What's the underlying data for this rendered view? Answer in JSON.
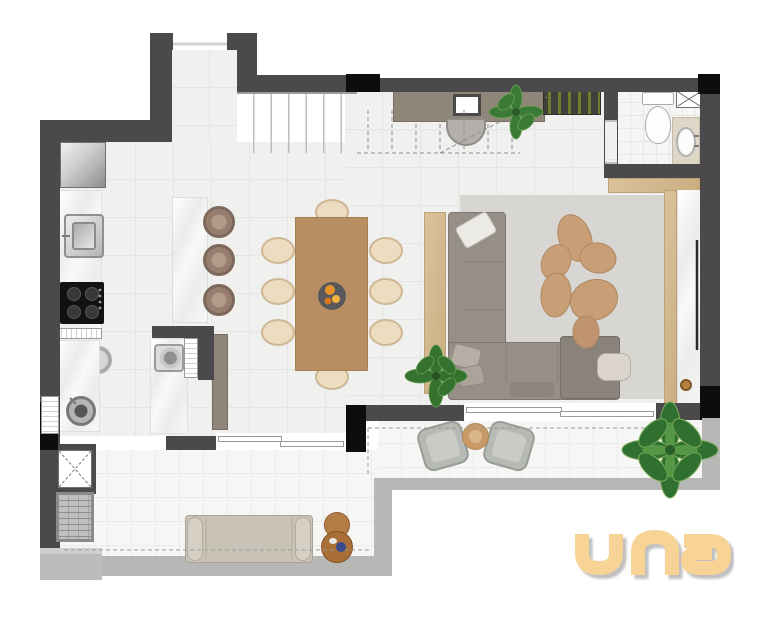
{
  "logo": {
    "text": "una"
  },
  "palette": {
    "wall": "#4A4A4C",
    "column": "#0D0D0D",
    "floor": "#F0F0EE",
    "floor_line": "#E4E4E2",
    "balcony": "#F6F6F4",
    "rail": "#B7B7B5",
    "rug": "#D7D6D2",
    "sofa": "#958F87",
    "sofa_dark": "#89837B",
    "wood": "#B78F63",
    "wood_light": "#D9C29C",
    "cream": "#ECDCC0",
    "stool": "#977D6E",
    "taupe": "#8F8579",
    "plant": "#35722F",
    "gold": "#B5813F",
    "logo_gold": "#F7D396"
  },
  "inventory": {
    "dining_chairs": 8,
    "island_stools": 3,
    "stair_treads": 7,
    "wine_bottles": 6,
    "balcony_armchairs": 2,
    "sofa_pillows": 3,
    "plants": 4
  }
}
